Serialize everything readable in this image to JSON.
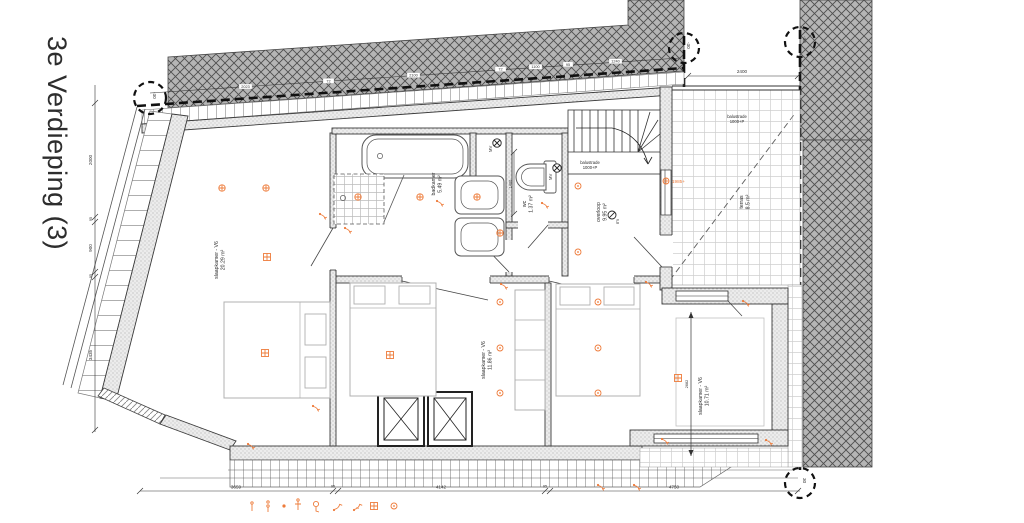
{
  "title": "3e Verdieping (3)",
  "colors": {
    "accent_orange": "#ee7c3b",
    "roof_hatch": "#b5b5b5",
    "wall_fill": "#ededed",
    "line": "#3a3a3a"
  },
  "rooms": {
    "slaapkamer_links": {
      "name": "slaapkamer - V6",
      "area": "20.29 m²"
    },
    "slaapkamer_midden": {
      "name": "slaapkamer - V6",
      "area": "11.86 m²"
    },
    "slaapkamer_rechts": {
      "name": "slaapkamer - V6",
      "area": "10.71 m²"
    },
    "badkamer": {
      "name": "badkamer",
      "area": "5.49 m²"
    },
    "wc": {
      "name": "wc",
      "area": "1.37 m²"
    },
    "overloop": {
      "name": "overloop",
      "area": "9.95 m²"
    },
    "terras": {
      "name": "terras",
      "area": "8.5 m²"
    }
  },
  "annotations": {
    "balustrade_stair_1": "balustrade",
    "balustrade_stair_2": "1000+P",
    "balustrade_terras_1": "balustrade",
    "balustrade_terras_2": "1000+P",
    "level_1985": "1985+",
    "rm": "rm",
    "mv_1": "MV",
    "mv_2": "MV"
  },
  "level_markers": {
    "top_left": "-30",
    "top_mid": "-30",
    "top_right": "-30",
    "bottom_right": "30"
  },
  "dimensions": {
    "bottom": [
      "3659",
      "95",
      "4142",
      "95",
      "4750"
    ],
    "left": [
      "2000",
      "95",
      "900",
      "95",
      "3435"
    ],
    "terras_breedte": "2400",
    "wc_diepte": "1400",
    "kamer_hoogte": "2682",
    "nok": [
      "2023",
      "72",
      "2100",
      "72",
      "1100",
      "95",
      "1240"
    ]
  },
  "legend": {
    "items": [
      "ceiling-light",
      "pendant-light",
      "spot",
      "wall-light",
      "switched-light",
      "single-switch",
      "double-switch",
      "floor-heating",
      "socket"
    ]
  }
}
